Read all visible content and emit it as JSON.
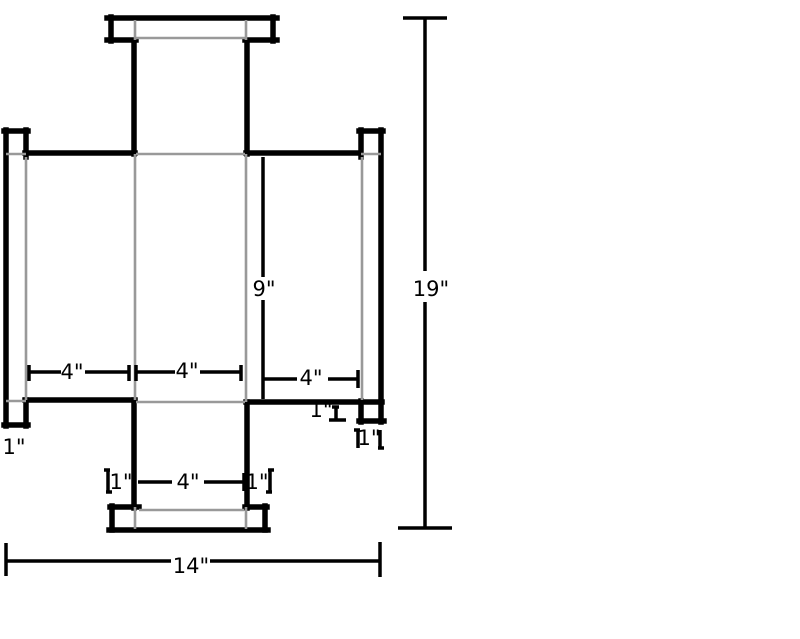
{
  "drawing": {
    "description": "Flat pattern technical drawing of a cross-shaped part with flanged ends and dimension annotations",
    "canvas": {
      "width": 800,
      "height": 639,
      "background": "#ffffff"
    },
    "style": {
      "outline_color": "#000000",
      "outline_width": 5.5,
      "fold_color": "#999999",
      "fold_width": 2.6,
      "dim_color": "#000000",
      "dim_width": 3.5,
      "label_color": "#000000",
      "label_font_size": 21
    },
    "outline_lines": [
      [
        107,
        18,
        277,
        18
      ],
      [
        111,
        17,
        111,
        41
      ],
      [
        273,
        17,
        273,
        41
      ],
      [
        107,
        40,
        136,
        40
      ],
      [
        245,
        40,
        277,
        40
      ],
      [
        134,
        41,
        134,
        154
      ],
      [
        247,
        41,
        247,
        154
      ],
      [
        25,
        153,
        135,
        153
      ],
      [
        246,
        153,
        359,
        153
      ],
      [
        4,
        131,
        28,
        131
      ],
      [
        6,
        130,
        6,
        426
      ],
      [
        26,
        130,
        26,
        157
      ],
      [
        26,
        400,
        26,
        426
      ],
      [
        4,
        425,
        28,
        425
      ],
      [
        359,
        131,
        383,
        131
      ],
      [
        381,
        130,
        381,
        422
      ],
      [
        361,
        130,
        361,
        157
      ],
      [
        361,
        401,
        361,
        422
      ],
      [
        359,
        421,
        384,
        421
      ],
      [
        25,
        400,
        135,
        400
      ],
      [
        246,
        402,
        382,
        402
      ],
      [
        134,
        400,
        134,
        508
      ],
      [
        247,
        402,
        247,
        508
      ],
      [
        110,
        507,
        139,
        507
      ],
      [
        245,
        507,
        267,
        507
      ],
      [
        112,
        506,
        112,
        530
      ],
      [
        265,
        506,
        265,
        530
      ],
      [
        109,
        530,
        268,
        530
      ]
    ],
    "fold_lines": [
      [
        135,
        20,
        135,
        40
      ],
      [
        246,
        20,
        246,
        40
      ],
      [
        136,
        38,
        245,
        38
      ],
      [
        6,
        154,
        26,
        154
      ],
      [
        136,
        154,
        245,
        154
      ],
      [
        361,
        154,
        381,
        154
      ],
      [
        26,
        157,
        26,
        400
      ],
      [
        362,
        157,
        362,
        400
      ],
      [
        135,
        154,
        135,
        400
      ],
      [
        246,
        154,
        246,
        402
      ],
      [
        6,
        401,
        26,
        401
      ],
      [
        136,
        402,
        245,
        402
      ],
      [
        135,
        507,
        135,
        529
      ],
      [
        246,
        507,
        246,
        529
      ],
      [
        139,
        510,
        244,
        510
      ]
    ],
    "dimension_lines": [
      [
        403,
        18,
        447,
        18
      ],
      [
        425,
        19,
        425,
        271
      ],
      [
        425,
        302,
        425,
        527
      ],
      [
        398,
        528,
        452,
        528
      ],
      [
        263,
        157,
        263,
        277
      ],
      [
        263,
        300,
        263,
        399
      ],
      [
        6,
        543,
        6,
        576
      ],
      [
        380,
        542,
        380,
        577
      ],
      [
        7,
        561,
        171,
        561
      ],
      [
        210,
        561,
        379,
        561
      ],
      [
        29,
        365,
        29,
        381
      ],
      [
        129,
        365,
        129,
        381
      ],
      [
        29,
        372,
        61,
        372
      ],
      [
        85,
        372,
        128,
        372
      ],
      [
        136,
        365,
        136,
        381
      ],
      [
        241,
        365,
        241,
        381
      ],
      [
        137,
        372,
        175,
        372
      ],
      [
        200,
        372,
        240,
        372
      ],
      [
        358,
        370,
        358,
        388
      ],
      [
        264,
        379,
        297,
        379
      ],
      [
        328,
        379,
        357,
        379
      ],
      [
        108,
        470,
        108,
        492
      ],
      [
        104,
        470,
        110,
        470
      ],
      [
        106,
        492,
        112,
        492
      ],
      [
        138,
        482,
        172,
        482
      ],
      [
        204,
        482,
        243,
        482
      ],
      [
        244,
        473,
        244,
        491
      ],
      [
        270,
        470,
        270,
        492
      ],
      [
        268,
        470,
        274,
        470
      ],
      [
        266,
        492,
        272,
        492
      ],
      [
        336,
        407,
        336,
        419
      ],
      [
        332,
        407,
        339,
        407
      ],
      [
        329,
        420,
        346,
        420
      ],
      [
        358,
        430,
        358,
        448
      ],
      [
        354,
        430,
        360,
        430
      ],
      [
        380,
        430,
        380,
        448
      ],
      [
        378,
        448,
        384,
        448
      ]
    ],
    "labels": [
      {
        "name": "dim-label-overall-height",
        "text": "19\"",
        "x": 431,
        "y": 296
      },
      {
        "name": "dim-label-overall-width",
        "text": "14\"",
        "x": 191,
        "y": 573
      },
      {
        "name": "dim-label-body-height",
        "text": "9\"",
        "x": 264,
        "y": 296
      },
      {
        "name": "dim-label-left-arm-length",
        "text": "4\"",
        "x": 72,
        "y": 379
      },
      {
        "name": "dim-label-center-width",
        "text": "4\"",
        "x": 187,
        "y": 378
      },
      {
        "name": "dim-label-right-arm-length",
        "text": "4\"",
        "x": 311,
        "y": 385
      },
      {
        "name": "dim-label-bottom-arm-width",
        "text": "4\"",
        "x": 188,
        "y": 489
      },
      {
        "name": "dim-label-bottom-left-tab",
        "text": "1\"",
        "x": 121,
        "y": 489
      },
      {
        "name": "dim-label-bottom-right-tab",
        "text": "1\"",
        "x": 257,
        "y": 489
      },
      {
        "name": "dim-label-right-flange-tab",
        "text": "1\"",
        "x": 321,
        "y": 417
      },
      {
        "name": "dim-label-right-flange-width",
        "text": "1\"",
        "x": 369,
        "y": 445
      },
      {
        "name": "dim-label-left-flange-width",
        "text": "1\"",
        "x": 14,
        "y": 454
      }
    ]
  }
}
